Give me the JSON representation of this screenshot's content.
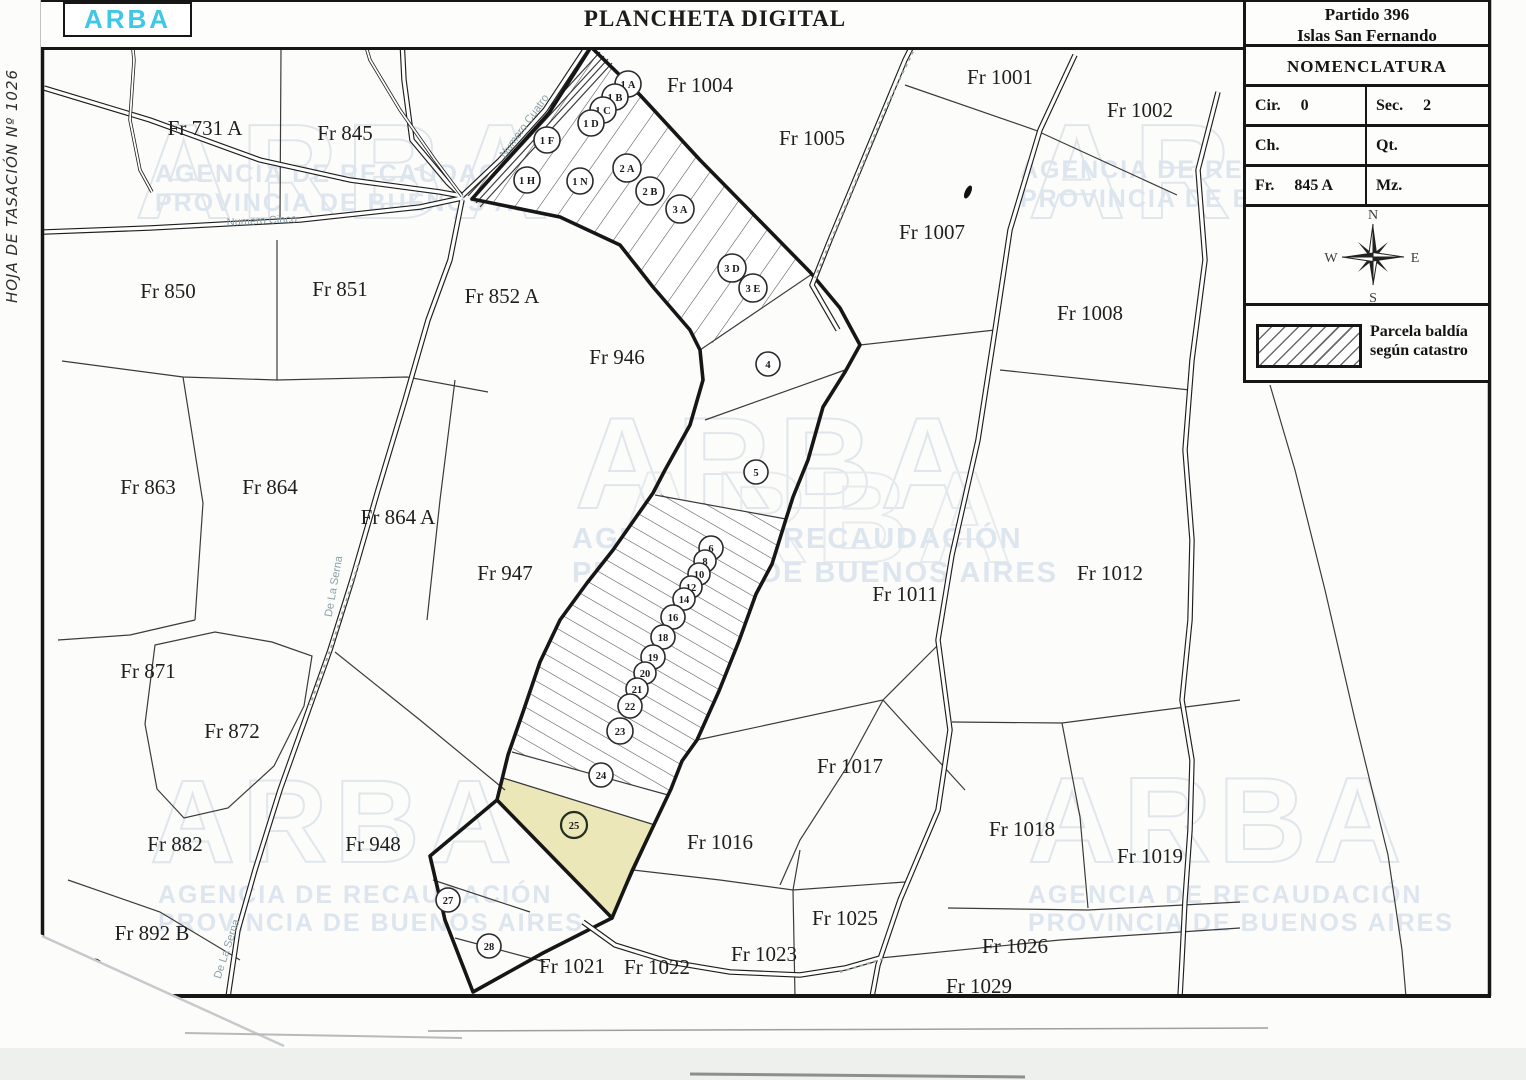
{
  "document": {
    "side_label": "HOJA DE TASACIÓN Nº 1026",
    "logo": "ARBA",
    "title": "PLANCHETA DIGITAL"
  },
  "info_panel": {
    "partido_line1": "Partido 396",
    "partido_line2": "Islas San Fernando",
    "nomenclatura_title": "NOMENCLATURA",
    "fields": [
      {
        "label": "Cir.",
        "value": "0"
      },
      {
        "label": "Sec.",
        "value": "2"
      },
      {
        "label": "Ch.",
        "value": ""
      },
      {
        "label": "Qt.",
        "value": ""
      },
      {
        "label": "Fr.",
        "value": "845 A"
      },
      {
        "label": "Mz.",
        "value": ""
      }
    ],
    "compass": {
      "n": "N",
      "e": "E",
      "s": "S",
      "w": "W"
    },
    "legend_line1": "Parcela baldía",
    "legend_line2": "según catastro"
  },
  "map": {
    "watermark_word": "ARBA",
    "watermark_line1": "AGENCIA DE RECAUDACIÓN",
    "watermark_line2": "PROVINCIA DE BUENOS AIRES",
    "highlight_color": "#ece7b8",
    "logo_color": "#3ec7e6",
    "road_labels": [
      "Numero Cuatro",
      "Numero Cinco",
      "De La Serna",
      "De La Serna"
    ],
    "parcels": [
      "Fr 731 A",
      "Fr 845",
      "Fr 1004",
      "Fr 1005",
      "Fr 1001",
      "Fr 1002",
      "Fr 1007",
      "Fr 1008",
      "Fr 850",
      "Fr 851",
      "Fr 852 A",
      "Fr 946",
      "Fr 863",
      "Fr 864",
      "Fr 864 A",
      "Fr 947",
      "Fr 1011",
      "Fr 1012",
      "Fr 871",
      "Fr 872",
      "Fr 882",
      "Fr 948",
      "Fr 892 B",
      "Fr 1017",
      "Fr 1016",
      "Fr 1018",
      "Fr 1019",
      "Fr 1025",
      "Fr 1023",
      "Fr 1026",
      "Fr 1029",
      "Fr 1021",
      "Fr 1022"
    ],
    "lots": [
      "1 A",
      "1 B",
      "1 C",
      "1 D",
      "1 F",
      "1 H",
      "1 N",
      "2 A",
      "2 B",
      "3 A",
      "3 D",
      "3 E",
      "4",
      "5",
      "6",
      "8",
      "10",
      "12",
      "14",
      "16",
      "18",
      "19",
      "20",
      "21",
      "22",
      "23",
      "24",
      "25",
      "27",
      "28"
    ]
  }
}
